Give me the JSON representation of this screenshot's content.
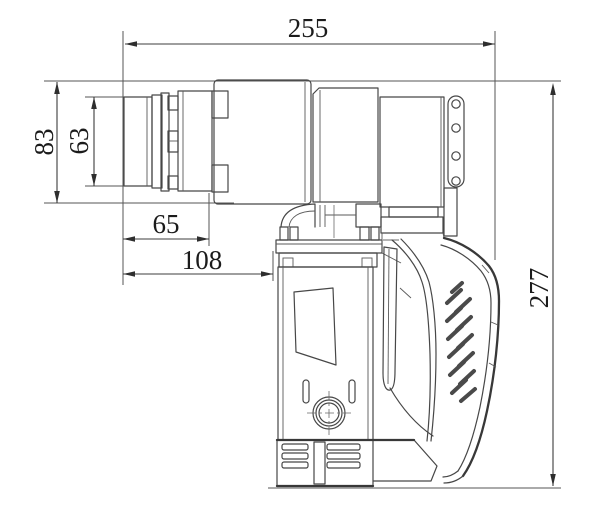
{
  "drawing": {
    "title": "Electric wrench side view technical drawing",
    "background": "#ffffff",
    "line_color": "#474747",
    "dimension_line_color": "#3c3c3c",
    "text_color": "#1b1b1b",
    "dimensions": {
      "overall_length": "255",
      "head_outer_height": "83",
      "head_inner_height": "63",
      "front_section_length": "65",
      "head_length": "108",
      "overall_height": "277"
    }
  }
}
